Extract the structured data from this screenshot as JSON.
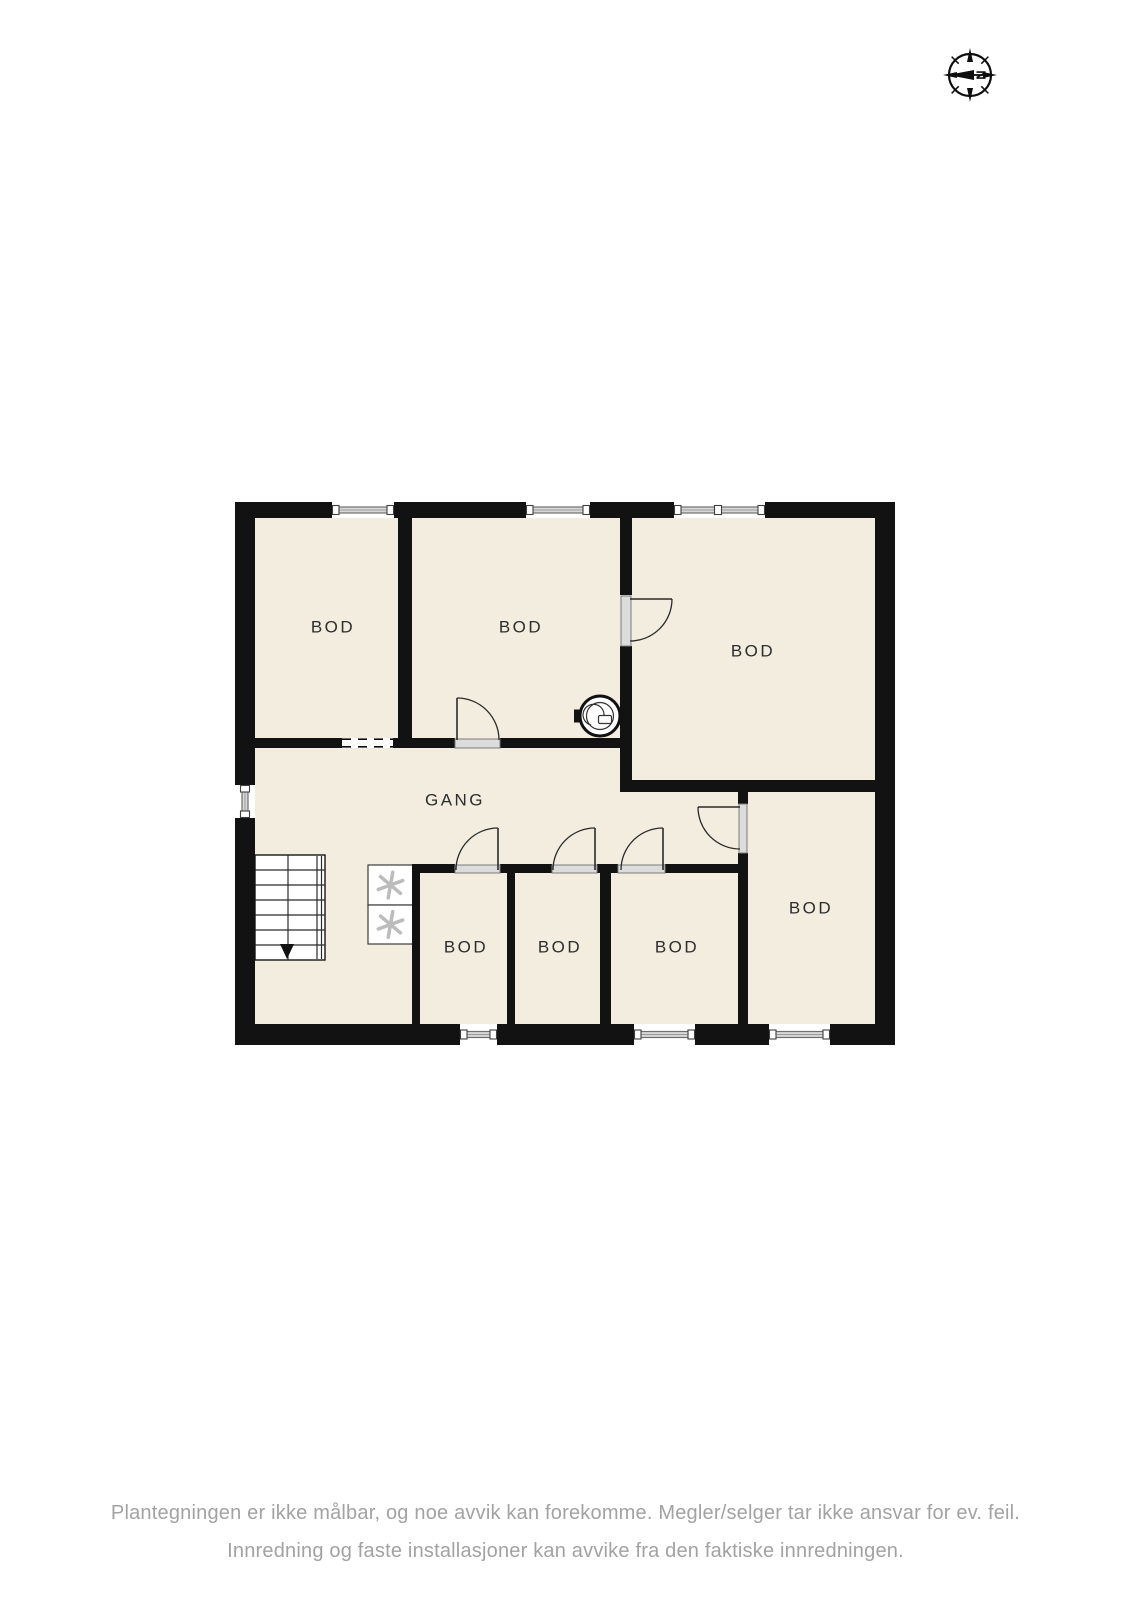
{
  "compass": {
    "label": "N",
    "cx": 970,
    "cy": 75,
    "r": 21
  },
  "footer": {
    "line1": "Plantegningen er ikke målbar, og noe avvik kan forekomme. Megler/selger tar ikke ansvar for ev. feil.",
    "line2": "Innredning og faste installasjoner kan avvike fra den faktiske innredningen.",
    "color": "#a2a2a2"
  },
  "plan": {
    "colors": {
      "floor": "#f2eddf",
      "wall": "#121212",
      "label": "#2d2d2d",
      "glaze_fill": "#d8d8d8",
      "glaze_stroke": "#6f6f6f",
      "glaze_mid": "#9a9a9a",
      "post_stroke": "#3f3f3f",
      "threshold_fill": "#dcdcdc",
      "threshold_stroke": "#7a7a7a",
      "door_line": "#2a2a2a",
      "stair_line": "#2a2a2a",
      "appliance_stroke": "#3c3c3c",
      "appliance_glyph": "#bcbcbc",
      "symbol_line": "#333333"
    },
    "floor": {
      "x": 255,
      "y": 518,
      "w": 620,
      "h": 506
    },
    "walls": [
      [
        235,
        502,
        97,
        16
      ],
      [
        394,
        502,
        132,
        16
      ],
      [
        590,
        502,
        84,
        16
      ],
      [
        765,
        502,
        130,
        16
      ],
      [
        235,
        502,
        20,
        283
      ],
      [
        235,
        818,
        20,
        227
      ],
      [
        875,
        502,
        20,
        543
      ],
      [
        235,
        1024,
        225,
        21
      ],
      [
        497,
        1024,
        137,
        21
      ],
      [
        695,
        1024,
        74,
        21
      ],
      [
        830,
        1024,
        65,
        21
      ],
      [
        398,
        518,
        14,
        220
      ],
      [
        620,
        518,
        12,
        77
      ],
      [
        620,
        646,
        12,
        146
      ],
      [
        255,
        738,
        87,
        10
      ],
      [
        393,
        738,
        62,
        10
      ],
      [
        500,
        738,
        120,
        10
      ],
      [
        620,
        780,
        255,
        12
      ],
      [
        738,
        792,
        10,
        12
      ],
      [
        738,
        853,
        10,
        171
      ],
      [
        412,
        864,
        43,
        9
      ],
      [
        500,
        864,
        52,
        9
      ],
      [
        597,
        864,
        21,
        9
      ],
      [
        665,
        864,
        73,
        9
      ],
      [
        412,
        864,
        8,
        160
      ],
      [
        507,
        873,
        8,
        151
      ],
      [
        600,
        873,
        11,
        151
      ]
    ],
    "dashed_openings": [
      {
        "x": 342,
        "y": 738,
        "w": 51,
        "h": 10
      }
    ],
    "windows": [
      {
        "x": 332,
        "y": 502,
        "w": 62,
        "h": 16,
        "o": "h"
      },
      {
        "x": 526,
        "y": 502,
        "w": 64,
        "h": 16,
        "o": "h"
      },
      {
        "x": 674,
        "y": 502,
        "w": 91,
        "h": 16,
        "o": "h",
        "mullions": [
          718
        ]
      },
      {
        "x": 235,
        "y": 785,
        "w": 20,
        "h": 33,
        "o": "v"
      },
      {
        "x": 460,
        "y": 1024,
        "w": 37,
        "h": 21,
        "o": "h"
      },
      {
        "x": 634,
        "y": 1024,
        "w": 61,
        "h": 21,
        "o": "h"
      },
      {
        "x": 769,
        "y": 1024,
        "w": 61,
        "h": 21,
        "o": "h"
      }
    ],
    "doors": [
      {
        "name": "door-bod-top-middle",
        "threshold": [
          455,
          739,
          45,
          9
        ],
        "leaf": [
          457,
          740,
          457,
          698
        ],
        "arc": "M457,698 A42,42 0 0 1 499,740"
      },
      {
        "name": "door-bod-top-right",
        "threshold": [
          621,
          596,
          10,
          50
        ],
        "leaf": [
          630,
          599,
          672,
          599
        ],
        "arc": "M672,599 A42,42 0 0 1 630,641"
      },
      {
        "name": "door-bod-right",
        "threshold": [
          739,
          804,
          8,
          49
        ],
        "leaf": [
          740,
          807,
          698,
          807
        ],
        "arc": "M698,807 A42,42 0 0 0 740,849"
      },
      {
        "name": "door-bod-small-1",
        "threshold": [
          455,
          865,
          45,
          8
        ],
        "leaf": [
          498,
          870,
          498,
          828
        ],
        "arc": "M498,828 A42,42 0 0 0 456,870"
      },
      {
        "name": "door-bod-small-2",
        "threshold": [
          552,
          865,
          45,
          8
        ],
        "leaf": [
          595,
          870,
          595,
          828
        ],
        "arc": "M595,828 A42,42 0 0 0 553,870"
      },
      {
        "name": "door-bod-small-3",
        "threshold": [
          618,
          865,
          47,
          8
        ],
        "leaf": [
          663,
          870,
          663,
          828
        ],
        "arc": "M663,828 A42,42 0 0 0 621,870"
      }
    ],
    "rooms": [
      {
        "label": "BOD",
        "x": 333,
        "y": 627
      },
      {
        "label": "BOD",
        "x": 521,
        "y": 627
      },
      {
        "label": "BOD",
        "x": 753,
        "y": 651
      },
      {
        "label": "GANG",
        "x": 455,
        "y": 800
      },
      {
        "label": "BOD",
        "x": 466,
        "y": 947
      },
      {
        "label": "BOD",
        "x": 560,
        "y": 947
      },
      {
        "label": "BOD",
        "x": 677,
        "y": 947
      },
      {
        "label": "BOD",
        "x": 811,
        "y": 908
      }
    ],
    "stairs": {
      "x": 255,
      "y": 855,
      "w": 70,
      "h": 105,
      "treads": 7,
      "mid_x": 288,
      "rail_x": [
        317,
        321.5
      ],
      "arrow": {
        "tip": [
          287,
          959
        ],
        "base_y": 944,
        "half_w": 7
      }
    },
    "appliances": [
      {
        "x": 368,
        "y": 865,
        "w": 45,
        "h": 40
      },
      {
        "x": 368,
        "y": 905,
        "w": 45,
        "h": 39
      }
    ],
    "fan": {
      "cx": 600,
      "cy": 716,
      "r": 20
    }
  }
}
